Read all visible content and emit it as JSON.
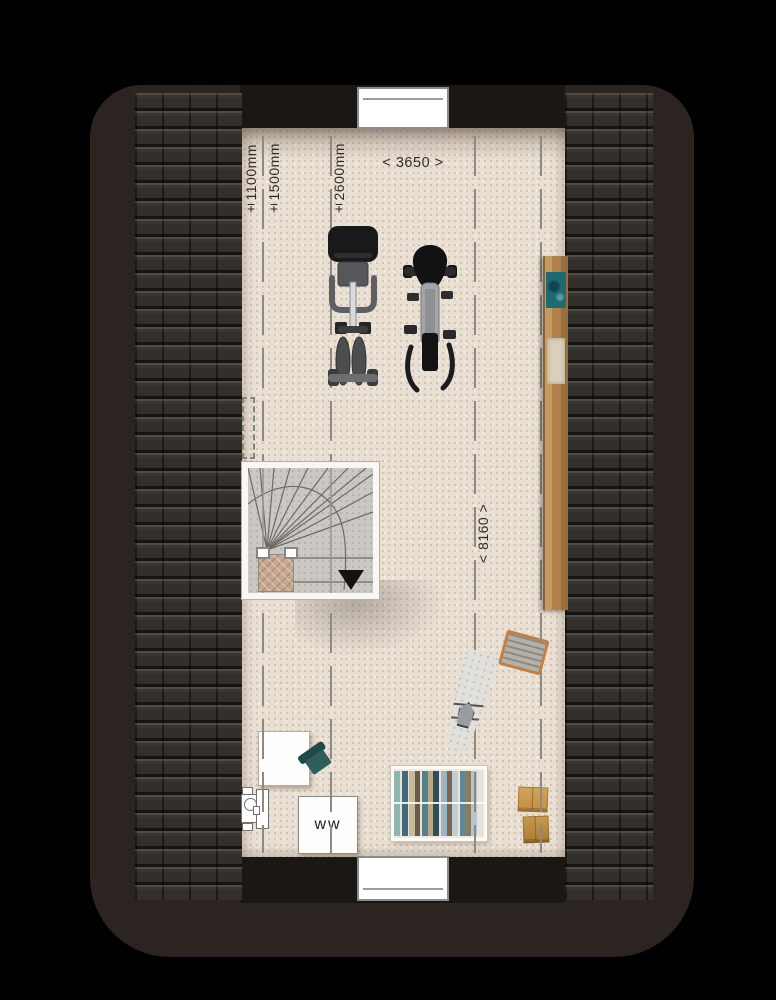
{
  "page": {
    "type": "architectural floor plan",
    "view": "attic / loft storey, top-down"
  },
  "dimension_labels": {
    "clearance_1100": "±1100mm",
    "clearance_1500": "±1500mm",
    "clearance_2600": "±2600mm",
    "room_width": "< 3650 >",
    "room_length": "< 8160 >"
  },
  "appliances": {
    "hot_water_unit_label": "ww"
  },
  "colors": {
    "canvas": "#000000",
    "roof_edge": "#2b2420",
    "roof_tiles": "#332f2a",
    "roof_band": "#1a1714",
    "floor": "#e9dfd3",
    "guide_line": "#8d8a84",
    "stair_arrow": "#121212",
    "wood_shelf": "#b0814b",
    "chair_teal": "#2e5e5c",
    "basket_tan": "#c28144",
    "box_tan": "#c39046"
  },
  "furniture_icons": [
    {
      "name": "winder-staircase"
    },
    {
      "name": "exercise-bike"
    },
    {
      "name": "spin-bike"
    },
    {
      "name": "wooden-shelf-board"
    },
    {
      "name": "desk"
    },
    {
      "name": "desk-chair"
    },
    {
      "name": "utility-fixture"
    },
    {
      "name": "hot-water-unit"
    },
    {
      "name": "clothes-rack"
    },
    {
      "name": "ironing-board"
    },
    {
      "name": "laundry-basket"
    },
    {
      "name": "storage-boxes"
    }
  ]
}
